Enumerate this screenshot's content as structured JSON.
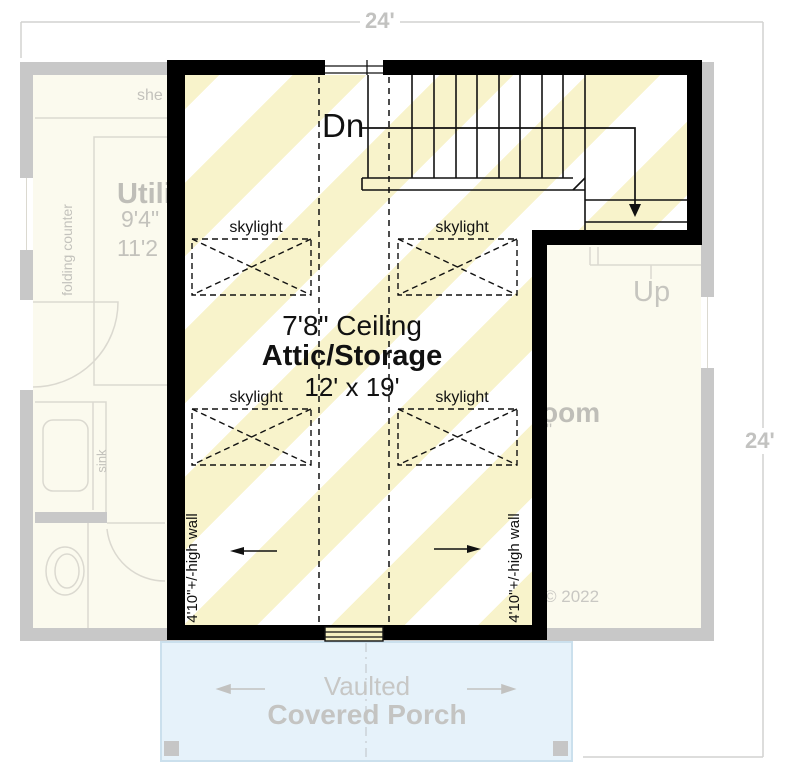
{
  "dimensions": {
    "top_width": "24'",
    "right_height": "24'"
  },
  "attic": {
    "down_label": "Dn",
    "ceiling_height": "7'8\" Ceiling",
    "room_name": "Attic/Storage",
    "room_size": "12' x 19'",
    "skylight_label": "skylight",
    "left_wall_height_note": "4'10\"+/-high wall",
    "right_wall_height_note": "4'10\"+/-high wall"
  },
  "lower_floor": {
    "shelf_label_partial": "she",
    "folding_counter_label": "folding counter",
    "utility_room_partial": "Utili",
    "utility_dim_partial_1": "9'4\"",
    "utility_dim_partial_2": "11'2",
    "sink_label": "sink",
    "up_label": "Up",
    "bedroom_partial": "oom",
    "bedroom_dim_partial": "\"",
    "copyright": "© 2022"
  },
  "porch": {
    "line1": "Vaulted",
    "line2": "Covered Porch"
  },
  "colors": {
    "wall_black": "#000000",
    "stripe_yellow": "#f8f3cb",
    "faded_wall_gray": "#c8c8c8",
    "faded_floor_cream": "#fbfaee",
    "faded_line_gray": "#dbd9d0",
    "porch_fill": "#e6f2fa",
    "porch_border": "#cbe0ed",
    "dimension_gray": "#d2d2d0"
  }
}
